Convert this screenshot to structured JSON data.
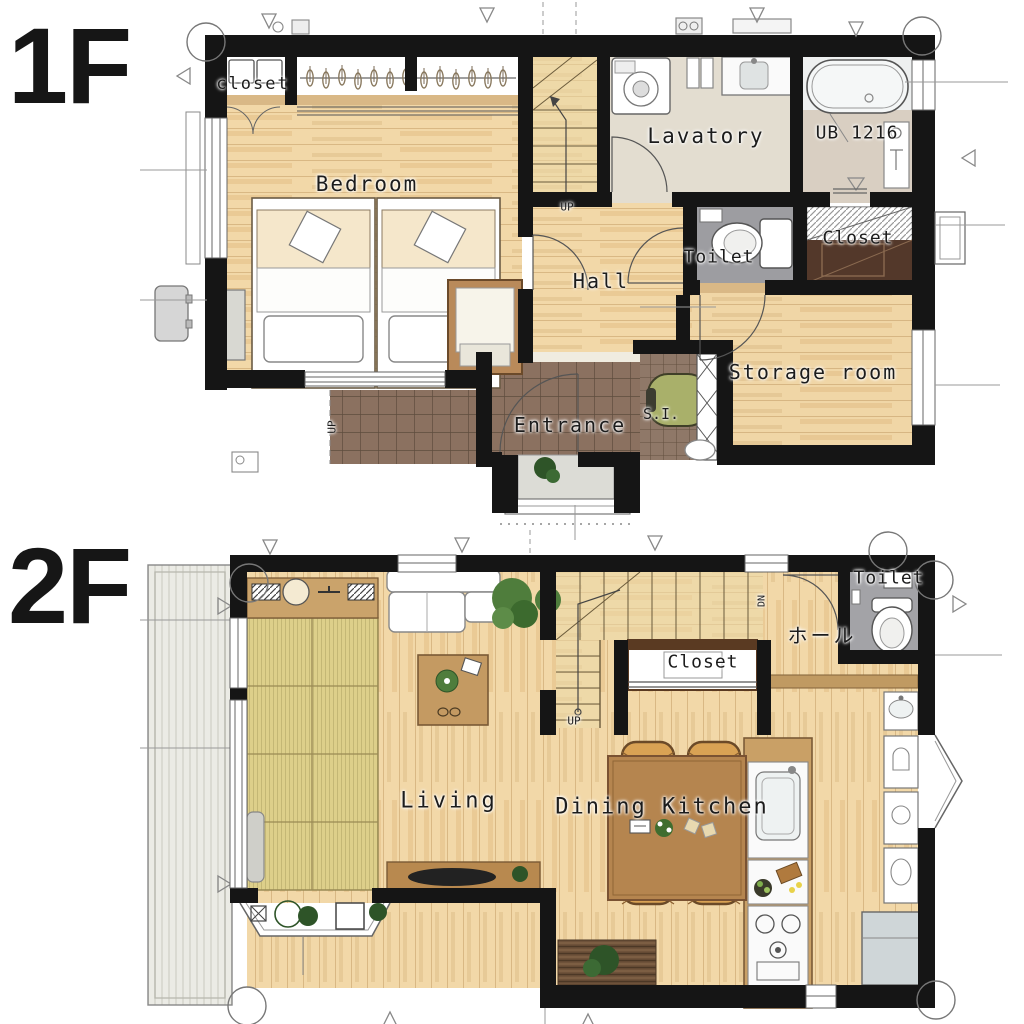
{
  "floor1": {
    "title": "1F",
    "labels": {
      "closet_small": "closet",
      "bedroom": "Bedroom",
      "lavatory": "Lavatory",
      "bath": "UB 1216",
      "stairs_up": "UP",
      "hall": "Hall",
      "toilet": "Toilet",
      "closet": "Closet",
      "storage": "Storage room",
      "entrance": "Entrance",
      "shoe_closet": "S.I.",
      "approach_up": "UP"
    }
  },
  "floor2": {
    "title": "2F",
    "labels": {
      "toilet": "Toilet",
      "hall": "ホール",
      "stairs_dn": "DN",
      "closet": "Closet",
      "stairs_up": "UP",
      "living": "Living",
      "dining_kitchen": "Dining Kitchen"
    }
  },
  "palette": {
    "wall": "#151515",
    "wood_floor": "#f2d8a8",
    "wood_stairs": "#eed9a8",
    "tatami": "#ddcf8a",
    "tile_brown": "#8b7160",
    "tile_grout": "#5e4c3e",
    "gray_floor": "#9d9da1",
    "lavatory_floor": "#e3ddd0",
    "bath_floor": "#d9cfc2",
    "balcony": "#ebebe5",
    "closet_dark": "#53382a",
    "counter_wood": "#c9a066",
    "table_wood": "#b5854f",
    "chair": "#d9a254",
    "plant_green": "#4f7d3c",
    "deck_brown": "#6e523a",
    "stroller_green": "#a9b06a",
    "appliance_gray": "#cfd6d8"
  }
}
